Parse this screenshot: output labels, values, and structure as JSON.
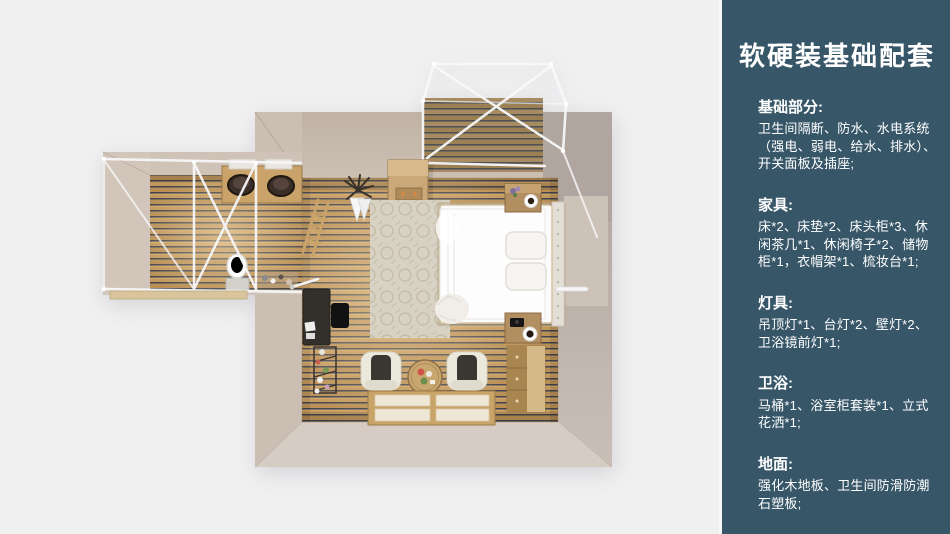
{
  "palette": {
    "background": "#f0f0f1",
    "sidebar_bg": "#375668",
    "wall_beige": "#c6b9ac",
    "wall_taupe": "#b1a69f",
    "floor_wood": "#c2975c",
    "frame_white": "#f8f8fa",
    "text": "#ffffff"
  },
  "floorplan": {
    "description": "top-down 3D render of bedroom with bathroom wing and balcony",
    "elements": [
      "balcony-deck",
      "canopy-frame",
      "wardrobe",
      "coat-rack",
      "rug",
      "double-bed",
      "nightstand",
      "coffee-cup",
      "dresser",
      "armchair",
      "coffee-table",
      "floor-mat",
      "desk",
      "plant-stand",
      "bathroom",
      "double-sink",
      "toilet",
      "towel-ladder"
    ]
  },
  "sidebar": {
    "title": "软硬装基础配套",
    "sections": [
      {
        "heading": "基础部分:",
        "body": "卫生间隔断、防水、水电系统（强电、弱电、给水、排水）、开关面板及插座;"
      },
      {
        "heading": "家具:",
        "body": "床*2、床垫*2、床头柜*3、休闲茶几*1、休闲椅子*2、储物柜*1，衣帽架*1、梳妆台*1;"
      },
      {
        "heading": "灯具:",
        "body": "吊顶灯*1、台灯*2、壁灯*2、卫浴镜前灯*1;"
      },
      {
        "heading": "卫浴:",
        "body": "马桶*1、浴室柜套装*1、立式花洒*1;"
      },
      {
        "heading": "地面:",
        "body": "强化木地板、卫生间防滑防潮石塑板;"
      }
    ]
  }
}
